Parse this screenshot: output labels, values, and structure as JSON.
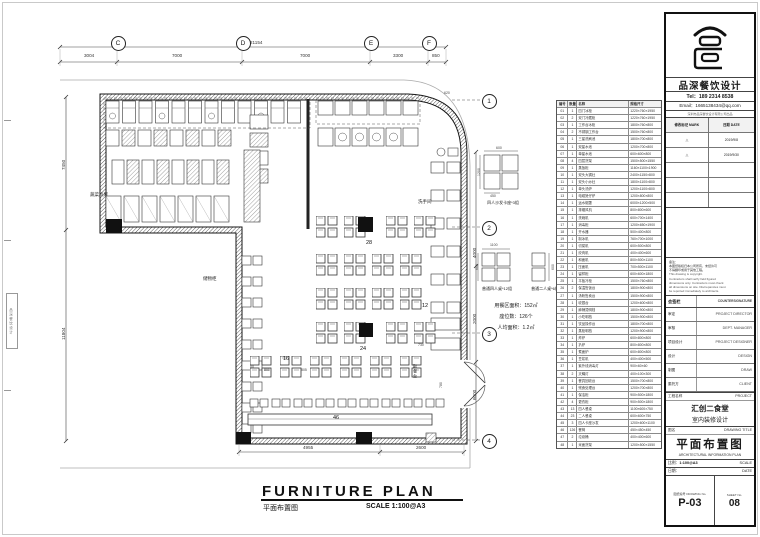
{
  "footer": {
    "title": "FURNITURE PLAN",
    "title_cn": "平面布置图",
    "scale": "SCALE 1:100@A3"
  },
  "grid": {
    "top": [
      {
        "label": "C"
      },
      {
        "label": "D"
      },
      {
        "label": "E"
      },
      {
        "label": "F"
      }
    ],
    "right": [
      "1",
      "2",
      "3",
      "4"
    ],
    "top_dims": [
      "3004",
      "7000",
      "7000",
      "3300",
      "850"
    ],
    "total_dim": "21154"
  },
  "plan": {
    "rooms": [
      "蔬菜冷库",
      "储物柜",
      "洗手间",
      "取餐台"
    ],
    "seat_counts": [
      "28",
      "12",
      "24",
      "16",
      "46"
    ],
    "stats": [
      "用餐区面积：152㎡",
      "座位数：126个",
      "人均面积：1.2㎡"
    ],
    "details": [
      {
        "label": "四人沙发卡座*3组",
        "dims": [
          "600",
          "1200",
          "450"
        ]
      },
      {
        "label": "普通四人桌*12组",
        "dims": [
          "1100",
          "600"
        ]
      },
      {
        "label": "普通二人桌*6组",
        "dims": [
          "600"
        ]
      }
    ],
    "misc_dims": [
      "4955",
      "2600",
      "7450",
      "11804",
      "4000",
      "2000",
      "6000",
      "800",
      "805",
      "730",
      "780",
      "620"
    ]
  },
  "schedule": {
    "headers": [
      "编号",
      "数量",
      "名称",
      "规格尺寸"
    ],
    "rows": [
      [
        "01",
        "1",
        "四门冰柜",
        "1220×760×1950"
      ],
      [
        "02",
        "2",
        "双门冷藏柜",
        "1220×760×1950"
      ],
      [
        "03",
        "1",
        "工作台冰柜",
        "1800×760×800"
      ],
      [
        "04",
        "2",
        "不锈钢工作台",
        "1500×760×800"
      ],
      [
        "05",
        "1",
        "三星洗刷池",
        "1800×700×800"
      ],
      [
        "06",
        "1",
        "双星水池",
        "1200×700×800"
      ],
      [
        "07",
        "1",
        "单星水池",
        "600×600×800"
      ],
      [
        "08",
        "4",
        "四层货架",
        "1500×500×1550"
      ],
      [
        "09",
        "1",
        "蒸饭柜",
        "1160×1100×1900"
      ],
      [
        "10",
        "1",
        "双头大锅灶",
        "2400×1150×800"
      ],
      [
        "11",
        "1",
        "双头小炒灶",
        "1800×1100×800"
      ],
      [
        "12",
        "1",
        "单头汤炉",
        "1200×1100×800"
      ],
      [
        "13",
        "1",
        "电磁煲仔炉",
        "1200×800×800"
      ],
      [
        "14",
        "1",
        "运水烟罩",
        "6000×1200×500"
      ],
      [
        "15",
        "1",
        "排烟风机",
        "800×800×600"
      ],
      [
        "16",
        "1",
        "洗碗机",
        "600×700×1400"
      ],
      [
        "17",
        "1",
        "消毒柜",
        "1200×650×1900"
      ],
      [
        "18",
        "1",
        "开水器",
        "500×400×800"
      ],
      [
        "19",
        "1",
        "制冰机",
        "760×700×1000"
      ],
      [
        "20",
        "1",
        "切菜机",
        "600×500×800"
      ],
      [
        "21",
        "1",
        "绞肉机",
        "400×400×600"
      ],
      [
        "22",
        "1",
        "和面机",
        "800×500×1100"
      ],
      [
        "23",
        "1",
        "压面机",
        "700×500×1100"
      ],
      [
        "24",
        "1",
        "留样柜",
        "600×600×1800"
      ],
      [
        "25",
        "1",
        "平板冷柜",
        "1500×760×800"
      ],
      [
        "26",
        "2",
        "保温售饭台",
        "1800×900×800"
      ],
      [
        "27",
        "1",
        "汤粉售卖台",
        "1500×900×800"
      ],
      [
        "28",
        "1",
        "收银台",
        "1200×600×800"
      ],
      [
        "29",
        "1",
        "麻辣烫明档",
        "1800×900×800"
      ],
      [
        "30",
        "1",
        "小吃明档",
        "1500×900×800"
      ],
      [
        "31",
        "1",
        "饮品操作台",
        "1800×700×800"
      ],
      [
        "32",
        "1",
        "蒸柜明档",
        "1200×900×800"
      ],
      [
        "33",
        "1",
        "炸炉",
        "600×800×800"
      ],
      [
        "34",
        "1",
        "扒炉",
        "800×800×800"
      ],
      [
        "35",
        "1",
        "煮面炉",
        "600×800×800"
      ],
      [
        "36",
        "1",
        "豆浆机",
        "400×400×500"
      ],
      [
        "37",
        "1",
        "紫外线消毒灯",
        "900×60×60"
      ],
      [
        "38",
        "2",
        "灭蝇灯",
        "400×100×300"
      ],
      [
        "39",
        "1",
        "餐具回收台",
        "1500×700×800"
      ],
      [
        "40",
        "1",
        "残食处理台",
        "1200×700×800"
      ],
      [
        "41",
        "1",
        "保洁柜",
        "900×500×1800"
      ],
      [
        "42",
        "4",
        "更衣柜",
        "900×500×1800"
      ],
      [
        "43",
        "13",
        "四人餐桌",
        "1100×600×750"
      ],
      [
        "44",
        "23",
        "二人餐桌",
        "600×600×750"
      ],
      [
        "45",
        "3",
        "四人卡座沙发",
        "1200×600×1100"
      ],
      [
        "46",
        "126",
        "餐椅",
        "450×450×450"
      ],
      [
        "47",
        "2",
        "垃圾桶",
        "400×400×600"
      ],
      [
        "48",
        "1",
        "米面货架",
        "1200×500×1550"
      ]
    ]
  },
  "titleblock": {
    "company": {
      "name": "品深餐饮设计",
      "tel": "Tel：189 2314 8538",
      "email": "Email：1665138434@qq.com",
      "sub": "深圳市品深餐饮设计有限公司出品"
    },
    "revisions": {
      "headers": [
        "修改标记 MARK",
        "日期 DATE"
      ],
      "rows": [
        [
          "△",
          "2019/9/8"
        ],
        [
          "△",
          "2019/9/30"
        ],
        [
          "",
          ""
        ],
        [
          "",
          ""
        ],
        [
          "",
          ""
        ]
      ]
    },
    "notes": {
      "cn": [
        "备注：",
        "本图纸版权归本公司所有，未经许可",
        "不得翻印或用于其他工程。"
      ],
      "en": [
        "This drawing is copyright.",
        "Contractors shall verify field figured",
        "dimensions only. Contractors must check",
        "all dimensions on site. Discrepancies must",
        "be reported immediately to architects."
      ]
    },
    "countersign": {
      "cn": "会签栏",
      "en": "COUNTERSIGNATURE",
      "rows": [
        [
          "审定",
          "PROJECT DIRECTOR"
        ],
        [
          "审核",
          "DEPT. MANAGER"
        ],
        [
          "项目设计",
          "PROJECT DESIGNER"
        ],
        [
          "设计",
          "DESIGN"
        ],
        [
          "制图",
          "DRAW"
        ],
        [
          "委托方",
          "CLIENT"
        ]
      ]
    },
    "project": {
      "label_cn": "工程名称",
      "label_en": "PROJECT",
      "name1": "汇创二食堂",
      "name2": "室内装修设计"
    },
    "drawing": {
      "label_cn": "图名",
      "label_en": "DRAWING TITLE",
      "title": "平面布置图",
      "subtitle": "ARCHITECTURAL INFORMATION PLAN"
    },
    "meta": {
      "scale_label": "比例：",
      "scale_value": "1:100@A3",
      "scale_en": "SCALE",
      "date_label": "日期：",
      "date_en": "DATE",
      "dno_label": "图纸编号 DRAWING No.",
      "dno": "P-03",
      "sno_label": "SHEET No.",
      "sno": "08"
    }
  }
}
